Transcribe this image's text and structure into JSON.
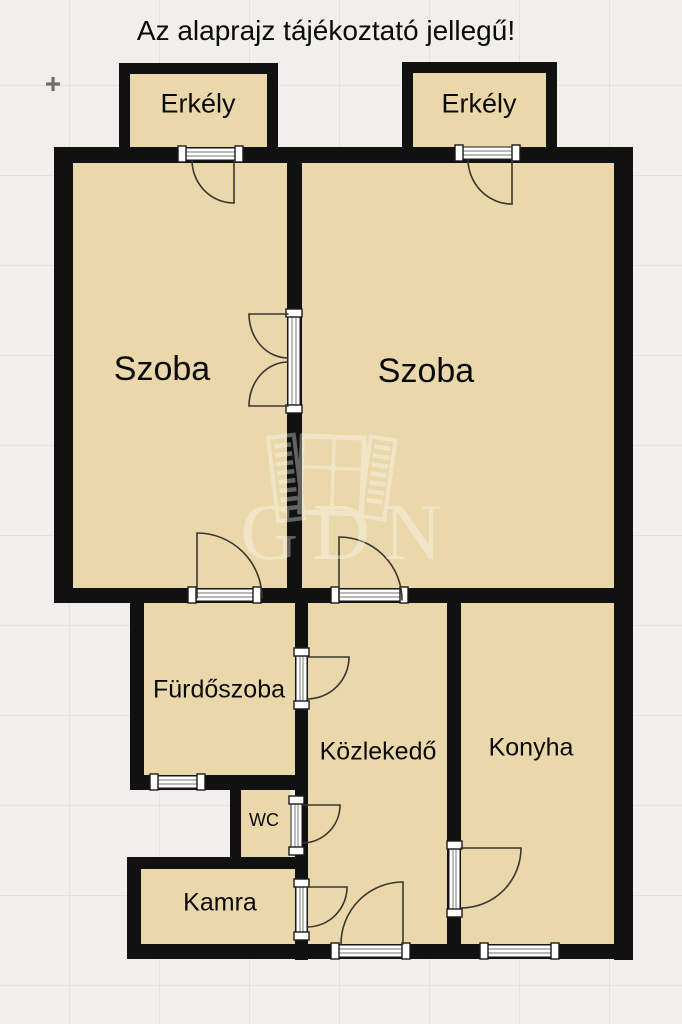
{
  "title": "Az alaprajz tájékoztató jellegű!",
  "rooms": {
    "balcony_left": {
      "label": "Erkély"
    },
    "balcony_right": {
      "label": "Erkély"
    },
    "room_left": {
      "label": "Szoba"
    },
    "room_right": {
      "label": "Szoba"
    },
    "bathroom": {
      "label": "Fürdőszoba"
    },
    "hallway": {
      "label": "Közlekedő"
    },
    "kitchen": {
      "label": "Konyha"
    },
    "wc": {
      "label": "WC"
    },
    "pantry": {
      "label": "Kamra"
    }
  },
  "watermark": {
    "text": "GDN",
    "icon": "open-window-icon"
  },
  "colors": {
    "background": "#f0efeb",
    "grid_line": "#e4e2dd",
    "floor": "#ead8ab",
    "wall": "#111111",
    "sill": "#ffffff",
    "door_arc": "#3b352f",
    "text": "#0a0a0a",
    "watermark": "#ffffff"
  }
}
